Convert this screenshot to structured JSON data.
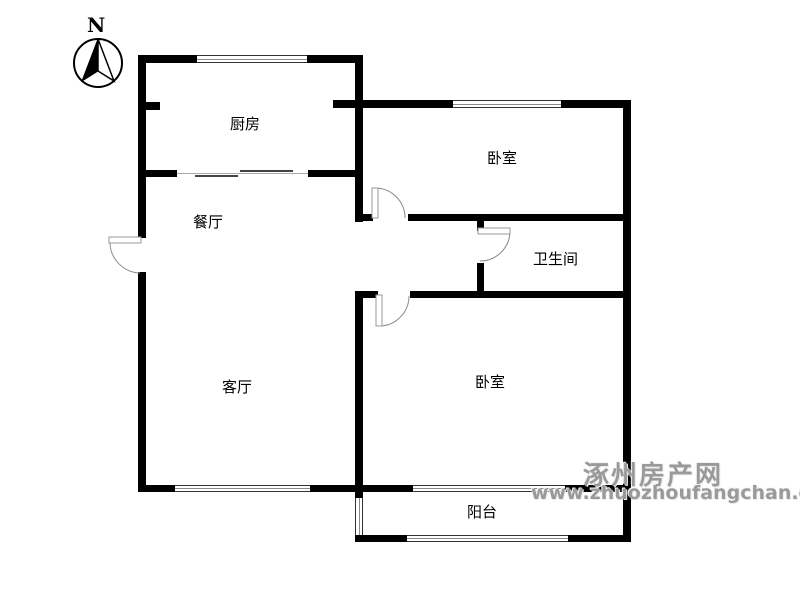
{
  "compass": {
    "north_label": "N"
  },
  "rooms": {
    "kitchen": {
      "label": "厨房"
    },
    "dining": {
      "label": "餐厅"
    },
    "bedroom_top": {
      "label": "卧室"
    },
    "bathroom": {
      "label": "卫生间"
    },
    "living": {
      "label": "客厅"
    },
    "bedroom_bottom": {
      "label": "卧室"
    },
    "balcony": {
      "label": "阳台"
    }
  },
  "watermark": {
    "site_name": "涿州房产网",
    "site_url": "www.zhuozhoufangchan.com",
    "color": "#9a9a9a"
  },
  "colors": {
    "wall": "#000000",
    "background": "#ffffff",
    "door_line": "#8c8c8c"
  }
}
